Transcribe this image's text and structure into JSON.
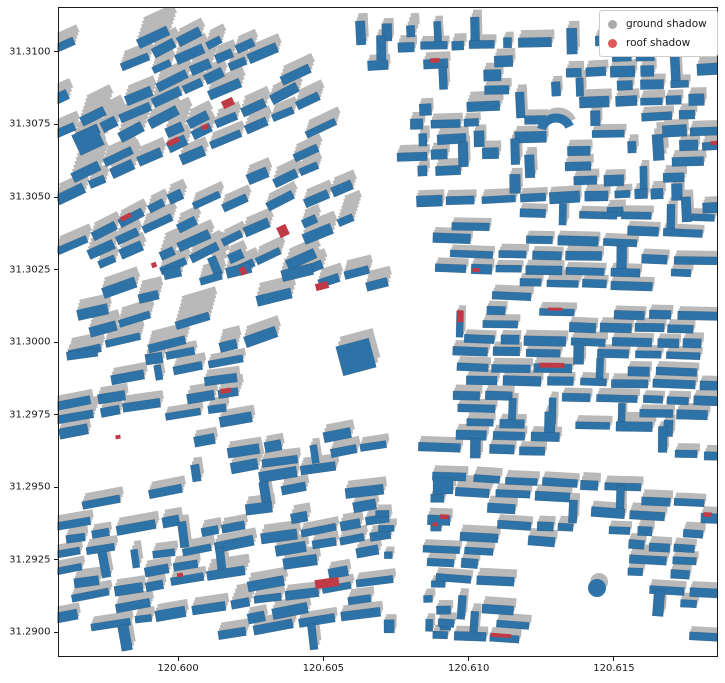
{
  "figure": {
    "width": 725,
    "height": 683,
    "background": "#ffffff"
  },
  "axes": {
    "rect": {
      "left": 57.5,
      "top": 7,
      "width": 660.5,
      "height": 649.5
    },
    "xlim": [
      120.59585,
      120.61858
    ],
    "ylim": [
      31.28916,
      31.31155
    ],
    "spine_color": "#1a1a1a",
    "tick_len": 4,
    "x_ticks": [
      {
        "v": 120.6,
        "label": "120.600"
      },
      {
        "v": 120.605,
        "label": "120.605"
      },
      {
        "v": 120.61,
        "label": "120.610"
      },
      {
        "v": 120.615,
        "label": "120.615"
      }
    ],
    "y_ticks": [
      {
        "v": 31.31,
        "label": "31.3100"
      },
      {
        "v": 31.3075,
        "label": "31.3075"
      },
      {
        "v": 31.305,
        "label": "31.3050"
      },
      {
        "v": 31.3025,
        "label": "31.3025"
      },
      {
        "v": 31.3,
        "label": "31.3000"
      },
      {
        "v": 31.2975,
        "label": "31.2975"
      },
      {
        "v": 31.295,
        "label": "31.2950"
      },
      {
        "v": 31.2925,
        "label": "31.2925"
      },
      {
        "v": 31.29,
        "label": "31.2900"
      }
    ]
  },
  "legend": {
    "x": 599,
    "y": 10,
    "items": [
      {
        "label": "ground shadow",
        "color": "#ababab"
      },
      {
        "label": "roof shadow",
        "color": "#e2595a"
      }
    ]
  },
  "chart_data": {
    "type": "map",
    "subject": "building footprints with ground shadows and roof shadows",
    "legend_entries": [
      "ground shadow",
      "roof shadow"
    ],
    "lon_range": [
      120.59585,
      120.61858
    ],
    "lat_range": [
      31.28916,
      31.31155
    ],
    "colors": {
      "building": "#2e73a7",
      "ground_shadow": "#b9b9b9",
      "roof_shadow": "#c03a46"
    },
    "seed": 7,
    "river": {
      "points": [
        [
          318,
          7
        ],
        [
          336,
          55
        ],
        [
          358,
          110
        ],
        [
          380,
          165
        ],
        [
          396,
          220
        ],
        [
          407,
          275
        ],
        [
          414,
          330
        ],
        [
          416,
          385
        ],
        [
          412,
          440
        ],
        [
          408,
          495
        ],
        [
          410,
          550
        ],
        [
          409,
          605
        ],
        [
          408,
          656
        ]
      ],
      "half_widths": [
        26,
        27,
        28,
        30,
        30,
        28,
        27,
        27,
        26,
        22,
        16,
        14,
        14
      ]
    },
    "roads": [
      {
        "x1": 58,
        "y1": 238,
        "x2": 345,
        "y2": 96,
        "w": 9
      },
      {
        "x1": 58,
        "y1": 330,
        "x2": 390,
        "y2": 242,
        "w": 8
      },
      {
        "x1": 400,
        "y1": 32,
        "x2": 400,
        "y2": 202,
        "w": 9
      },
      {
        "x1": 551,
        "y1": 32,
        "x2": 551,
        "y2": 205,
        "w": 7
      },
      {
        "x1": 604,
        "y1": 32,
        "x2": 604,
        "y2": 148,
        "w": 7
      },
      {
        "x1": 700,
        "y1": 30,
        "x2": 700,
        "y2": 200,
        "w": 7
      },
      {
        "x1": 385,
        "y1": 202,
        "x2": 718,
        "y2": 250,
        "w": 12
      },
      {
        "x1": 395,
        "y1": 278,
        "x2": 718,
        "y2": 303,
        "w": 10
      },
      {
        "x1": 449,
        "y1": 282,
        "x2": 459,
        "y2": 560,
        "w": 13
      },
      {
        "x1": 430,
        "y1": 466,
        "x2": 718,
        "y2": 472,
        "w": 8
      },
      {
        "x1": 50,
        "y1": 646,
        "x2": 720,
        "y2": 646,
        "w": 14
      },
      {
        "x1": 50,
        "y1": 18,
        "x2": 720,
        "y2": 18,
        "w": 22
      }
    ],
    "pockets": [
      {
        "x0": 58,
        "y0": 415,
        "x1": 232,
        "y1": 515,
        "keep": 0.22
      },
      {
        "x0": 520,
        "y0": 552,
        "x1": 648,
        "y1": 632,
        "keep": 0.18
      },
      {
        "x0": 58,
        "y0": 30,
        "x1": 128,
        "y1": 108,
        "keep": 0.5
      },
      {
        "x0": 240,
        "y0": 300,
        "x1": 388,
        "y1": 432,
        "keep": 0.12
      },
      {
        "x0": 230,
        "y0": 120,
        "x1": 300,
        "y1": 260,
        "keep": 0.55
      }
    ],
    "districts": [
      {
        "name": "upper-left",
        "bbox": [
          58,
          30,
          352,
          268
        ],
        "angle": -25,
        "row": 15.5,
        "bw": [
          14,
          34
        ],
        "bh": [
          7,
          11
        ],
        "gap": [
          3,
          8
        ],
        "skip": 0.34,
        "red_p": 0.02,
        "vert": 0.04,
        "ajit": 6,
        "shadow": [
          3.5,
          -11
        ],
        "tall_p": 0.1,
        "tall_m": [
          1.6,
          2.3
        ]
      },
      {
        "name": "mid-left",
        "bbox": [
          58,
          268,
          400,
          352
        ],
        "angle": -16,
        "row": 17,
        "bw": [
          16,
          40
        ],
        "bh": [
          7,
          12
        ],
        "gap": [
          3,
          9
        ],
        "skip": 0.4,
        "red_p": 0.025,
        "vert": 0.0,
        "ajit": 8,
        "shadow": [
          3.5,
          -13
        ],
        "tall_p": 0.16,
        "tall_m": [
          1.5,
          2.2
        ]
      },
      {
        "name": "lower-left",
        "bbox": [
          58,
          352,
          398,
          645
        ],
        "angle": -9,
        "row": 15,
        "bw": [
          16,
          40
        ],
        "bh": [
          7,
          11
        ],
        "gap": [
          3,
          8
        ],
        "skip": 0.3,
        "red_p": 0.02,
        "vert": 0.05,
        "ajit": 5,
        "shadow": [
          3,
          -8
        ],
        "tall_p": 0.07,
        "tall_m": [
          1.4,
          2.0
        ]
      },
      {
        "name": "riverside",
        "bbox": [
          378,
          495,
          455,
          645
        ],
        "angle": 0,
        "row": 14,
        "bw": [
          7,
          16
        ],
        "bh": [
          6,
          9
        ],
        "gap": [
          3,
          7
        ],
        "skip": 0.55,
        "red_p": 0.01,
        "vert": 0.2,
        "ajit": 3,
        "shadow": [
          2.5,
          -6
        ],
        "tall_p": 0,
        "tall_m": [
          1,
          1
        ]
      },
      {
        "name": "upper-right",
        "bbox": [
          352,
          30,
          718,
          212
        ],
        "angle": -2,
        "row": 15.5,
        "bw": [
          12,
          34
        ],
        "bh": [
          7,
          12
        ],
        "gap": [
          3,
          8
        ],
        "skip": 0.3,
        "red_p": 0.03,
        "vert": 0.3,
        "ajit": 3,
        "shadow": [
          2.5,
          -7
        ],
        "tall_p": 0.05,
        "tall_m": [
          1.4,
          1.9
        ]
      },
      {
        "name": "mid-right",
        "bbox": [
          395,
          212,
          718,
          468
        ],
        "angle": 1.5,
        "row": 14,
        "bw": [
          18,
          44
        ],
        "bh": [
          7,
          10
        ],
        "gap": [
          3,
          7
        ],
        "skip": 0.2,
        "red_p": 0.035,
        "vert": 0.08,
        "ajit": 2,
        "shadow": [
          2.5,
          -6
        ],
        "tall_p": 0.04,
        "tall_m": [
          1.3,
          1.8
        ]
      },
      {
        "name": "lower-right",
        "bbox": [
          428,
          468,
          718,
          643
        ],
        "angle": 3,
        "row": 14.5,
        "bw": [
          14,
          38
        ],
        "bh": [
          7,
          10
        ],
        "gap": [
          3,
          8
        ],
        "skip": 0.3,
        "red_p": 0.03,
        "vert": 0.1,
        "ajit": 3,
        "shadow": [
          2.5,
          -7
        ],
        "tall_p": 0.05,
        "tall_m": [
          1.3,
          1.8
        ]
      }
    ],
    "landmarks": {
      "big_buildings": [
        {
          "x": 356,
          "y": 357,
          "w": 34,
          "h": 30,
          "angle": -15,
          "shadow": [
            4,
            -10
          ]
        },
        {
          "x": 443,
          "y": 486,
          "w": 20,
          "h": 16,
          "angle": 0,
          "shadow": [
            3,
            -8
          ]
        },
        {
          "x": 88,
          "y": 140,
          "w": 26,
          "h": 22,
          "angle": -25,
          "shadow": [
            4,
            -12
          ]
        }
      ],
      "circle": {
        "x": 597,
        "y": 588,
        "r": 9,
        "shadow": [
          2,
          -6
        ]
      },
      "arc": {
        "x": 556,
        "y": 133,
        "r": 15,
        "start": 195,
        "end": 335,
        "lw": 9,
        "shadow": [
          2,
          -6
        ]
      },
      "red_patches": [
        {
          "x": 228,
          "y": 103,
          "w": 12,
          "h": 8,
          "angle": -25
        },
        {
          "x": 205,
          "y": 127,
          "w": 7,
          "h": 5,
          "angle": -20
        },
        {
          "x": 283,
          "y": 231,
          "w": 10,
          "h": 11,
          "angle": -25
        },
        {
          "x": 243,
          "y": 271,
          "w": 6,
          "h": 8,
          "angle": -20
        },
        {
          "x": 322,
          "y": 286,
          "w": 13,
          "h": 7,
          "angle": -15
        },
        {
          "x": 327,
          "y": 583,
          "w": 24,
          "h": 9,
          "angle": -8
        },
        {
          "x": 154,
          "y": 265,
          "w": 5,
          "h": 5,
          "angle": -20
        },
        {
          "x": 118,
          "y": 437,
          "w": 5,
          "h": 4,
          "angle": -10
        },
        {
          "x": 180,
          "y": 575,
          "w": 6,
          "h": 4,
          "angle": -8
        },
        {
          "x": 476,
          "y": 270,
          "w": 7,
          "h": 4,
          "angle": 0
        }
      ]
    }
  }
}
